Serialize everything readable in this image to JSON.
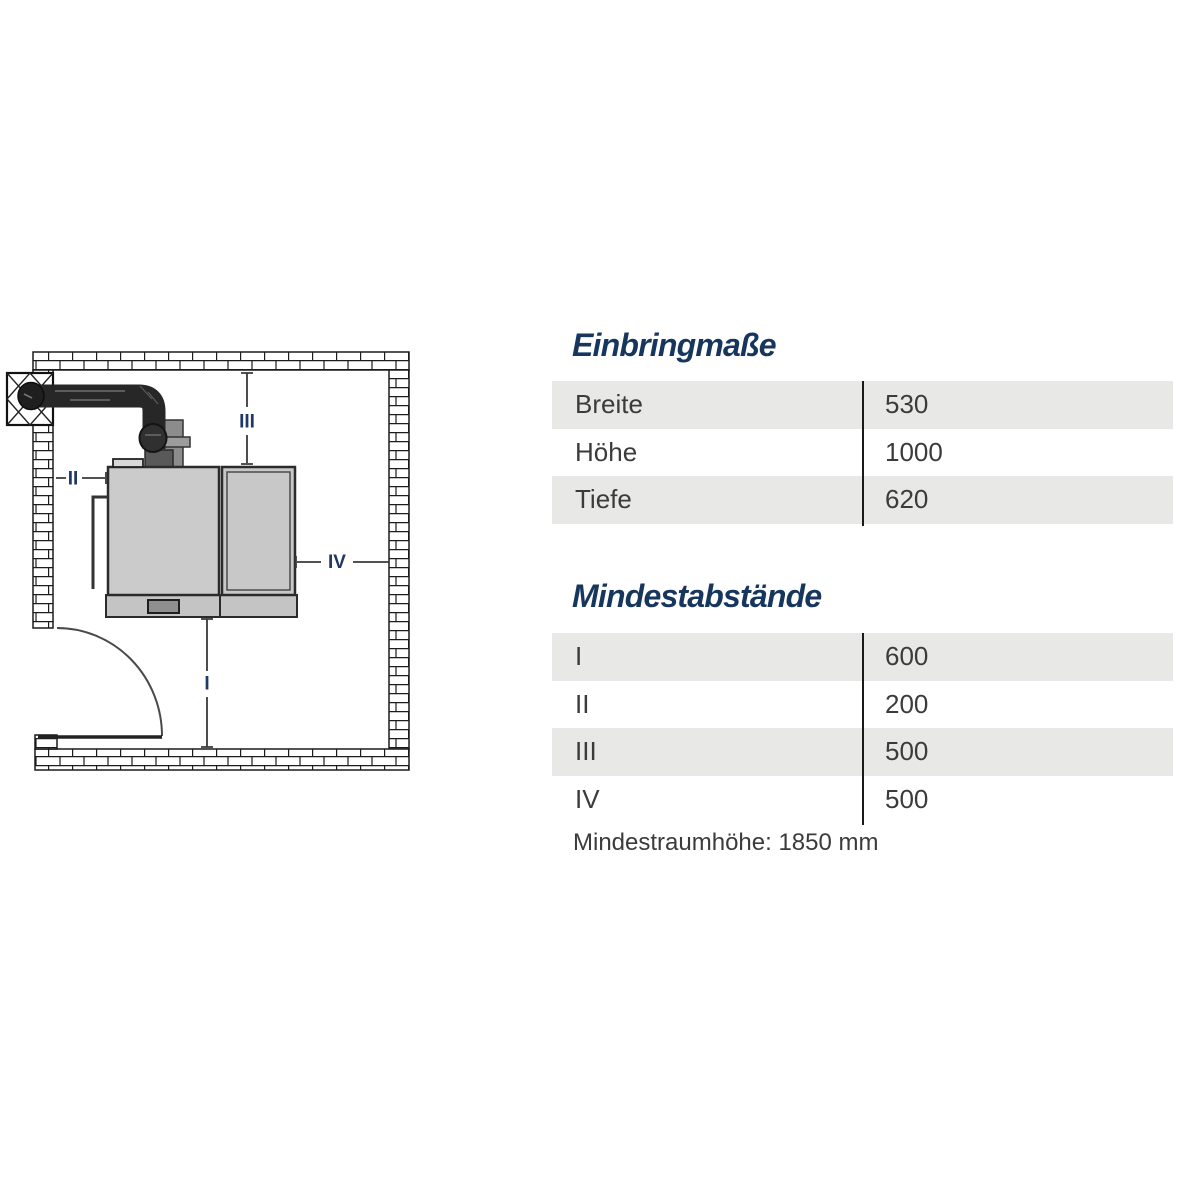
{
  "diagram": {
    "type": "boiler-installation-floor-plan",
    "markers": [
      {
        "id": "I",
        "label": "I"
      },
      {
        "id": "II",
        "label": "II"
      },
      {
        "id": "III",
        "label": "III"
      },
      {
        "id": "IV",
        "label": "IV"
      }
    ]
  },
  "sections": [
    {
      "heading": "Einbringmaße",
      "rows": [
        {
          "label": "Breite",
          "value": "530"
        },
        {
          "label": "Höhe",
          "value": "1000"
        },
        {
          "label": "Tiefe",
          "value": "620"
        }
      ]
    },
    {
      "heading": "Mindestabstände",
      "rows": [
        {
          "label": "I",
          "value": "600"
        },
        {
          "label": "II",
          "value": "200"
        },
        {
          "label": "III",
          "value": "500"
        },
        {
          "label": "IV",
          "value": "500"
        }
      ],
      "note": "Mindestraumhöhe: 1850 mm"
    }
  ],
  "colors": {
    "heading": "#17365d",
    "body_text": "#3b3b3b",
    "row_alt_background": "#e8e8e7",
    "column_divider": "#1a1a1a",
    "marker_label": "#1f3864",
    "wall_line": "#1c1c1c",
    "boiler_fill": "#cbcbcb",
    "pipe_fill": "#272727"
  }
}
